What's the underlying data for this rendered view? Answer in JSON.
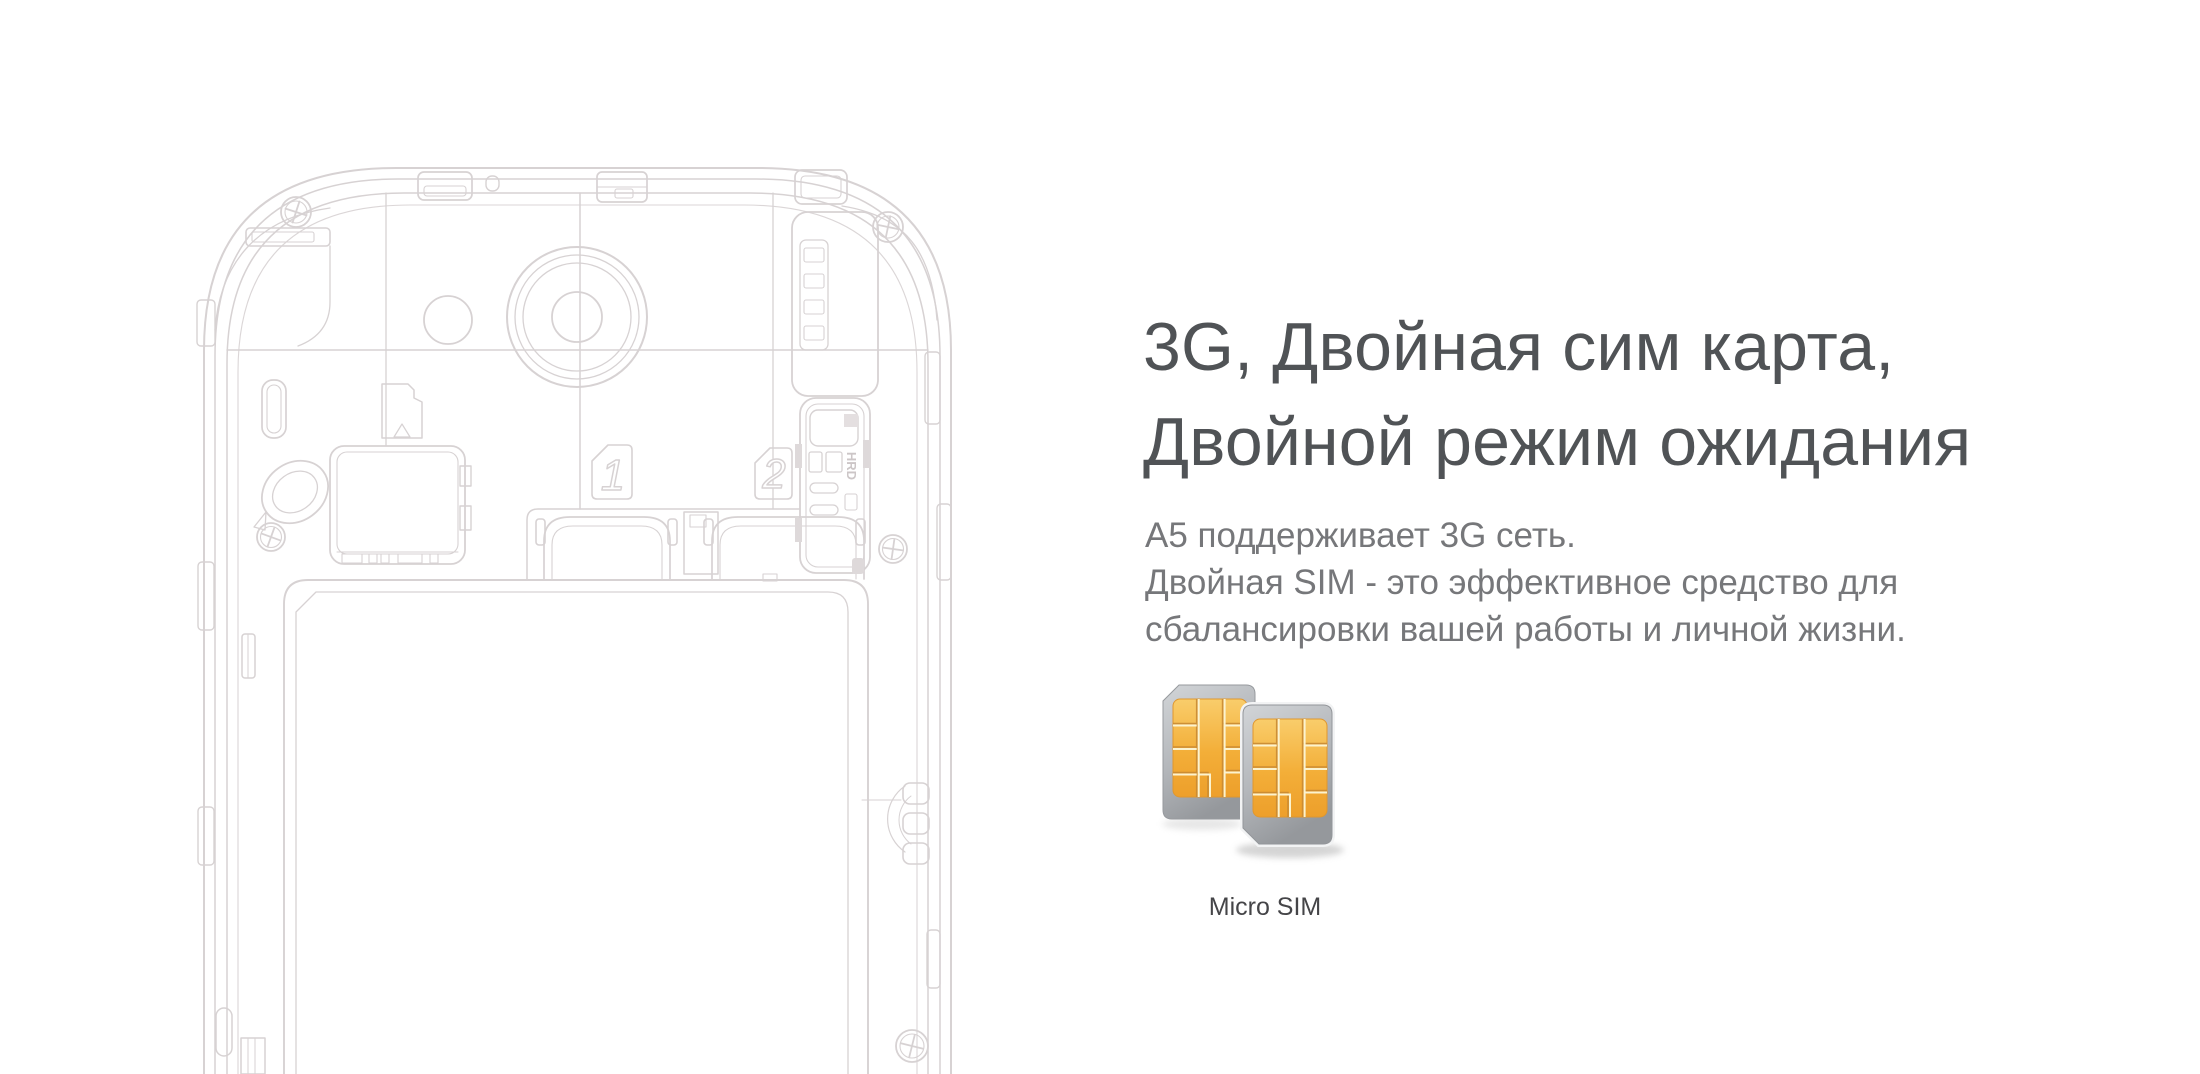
{
  "section": {
    "heading": {
      "line1": "3G, Двойная сим карта,",
      "line2": "Двойной режим ожидания"
    },
    "body": {
      "line1": "A5 поддерживает 3G сеть.",
      "line2": "Двойная SIM - это эффективное средство для",
      "line3": "сбалансировки вашей работы и личной жизни."
    },
    "sim_caption": "Micro SIM"
  },
  "illustration": {
    "name": "phone-back-internals-line-drawing",
    "sim_slot_labels": [
      "1",
      "2"
    ],
    "tray_text": "HRD"
  },
  "colors": {
    "background": "#ffffff",
    "line_art": "#d7d2d3",
    "heading_text": "#505356",
    "body_text": "#76777a",
    "caption_text": "#454548",
    "sim_chip_top": "#f8c95f",
    "sim_chip_bottom": "#ee9f2b",
    "sim_card_gray": "#b4b7bb"
  }
}
